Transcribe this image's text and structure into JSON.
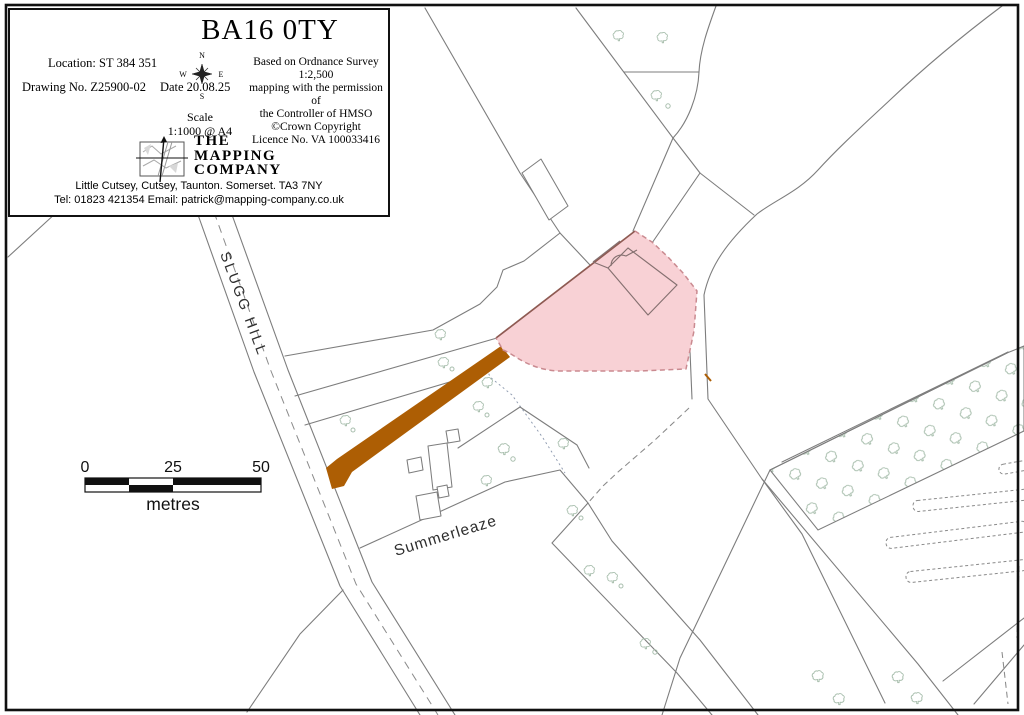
{
  "title_block": {
    "postcode": "BA16 0TY",
    "location": "Location: ST 384 351",
    "drawing_no": "Drawing No. Z25900-02",
    "date": "Date 20.08.25",
    "compass": {
      "n": "N",
      "s": "S",
      "e": "E",
      "w": "W"
    },
    "os_attribution": [
      "Based on Ordnance Survey 1:2,500",
      "mapping with the permission of",
      "the Controller of HMSO",
      "©Crown Copyright",
      "Licence No. VA 100033416"
    ],
    "scale_label": "Scale",
    "scale_value": "1:1000 @ A4",
    "company": {
      "line1": "THE",
      "line2": "MAPPING",
      "line3": "COMPANY"
    },
    "address": "Little Cutsey, Cutsey, Taunton. Somerset. TA3 7NY",
    "contact": "Tel: 01823 421354 Email: patrick@mapping-company.co.uk"
  },
  "map": {
    "road_label": "SLUGG HILL",
    "place_label": "Summerleaze",
    "scale_bar": {
      "tick0": "0",
      "tick25": "25",
      "tick50": "50",
      "unit": "metres"
    }
  },
  "icons": {
    "compass": "compass-rose",
    "logo": "map-crosshair-logo",
    "tree": "deciduous-tree-symbol"
  },
  "colors": {
    "site_fill": "#f8d1d5",
    "site_dash": "#ca8a90",
    "site_edge": "#8e5a52",
    "track_fill": "#ad5e04",
    "line_gray": "#7d7d7d",
    "tree_green": "#a9bfae"
  }
}
